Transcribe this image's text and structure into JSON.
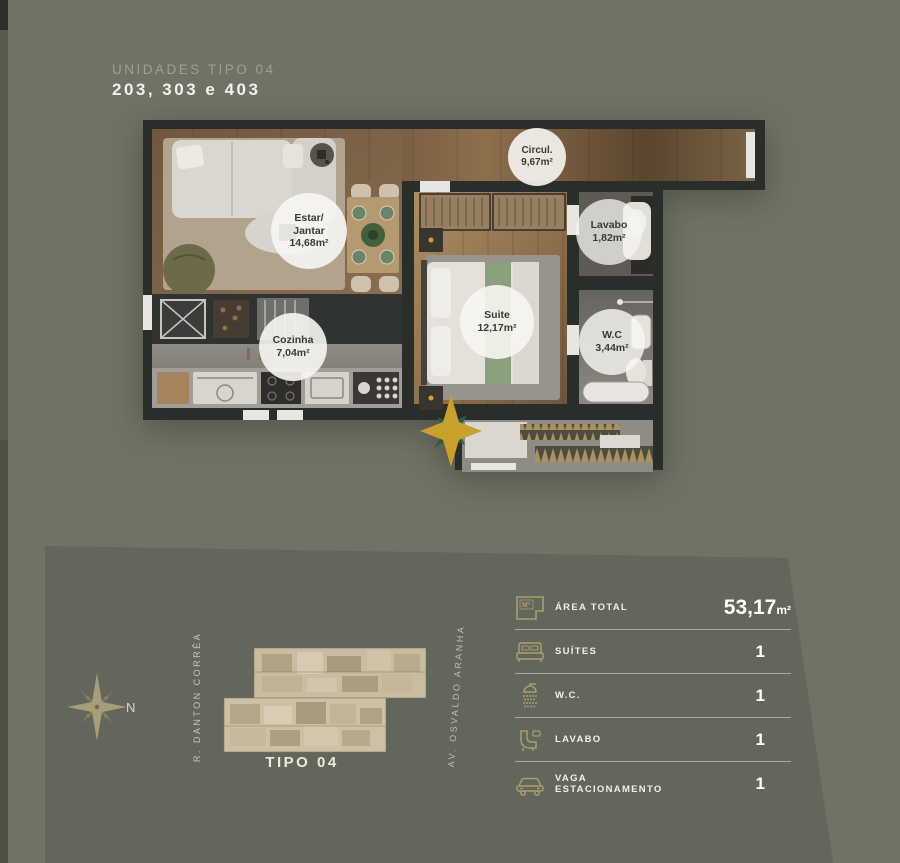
{
  "header": {
    "eyebrow": "UNIDADES TIPO 04",
    "title": "203, 303 e 403"
  },
  "floorplan": {
    "rooms": {
      "estar": {
        "l1": "Estar/",
        "l2": "Jantar",
        "l3": "14,68m²"
      },
      "circul": {
        "l1": "Circul.",
        "l2": "9,67m²"
      },
      "lavabo": {
        "l1": "Lavabo",
        "l2": "1,82m²"
      },
      "suite": {
        "l1": "Suite",
        "l2": "12,17m²"
      },
      "wc": {
        "l1": "W.C",
        "l2": "3,44m²"
      },
      "cozinha": {
        "l1": "Cozinha",
        "l2": "7,04m²"
      }
    }
  },
  "site": {
    "compass_label": "N",
    "street_left": "R. DANTON CORRÊA",
    "street_right": "AV. OSVALDO ARANHA",
    "miniplan_label": "TIPO 04"
  },
  "specs": {
    "area_icon_text": "M²",
    "rows": [
      {
        "label": "ÁREA TOTAL",
        "value": "53,17",
        "unit": "m²"
      },
      {
        "label": "SUÍTES",
        "value": "1"
      },
      {
        "label": "W.C.",
        "value": "1"
      },
      {
        "label": "LAVABO",
        "value": "1"
      },
      {
        "label": "VAGA ESTACIONAMENTO",
        "value": "1"
      }
    ]
  },
  "colors": {
    "background": "#6f7264",
    "platform": "#63665a",
    "accent_gold": "#a89f6e",
    "wall": "#2a2e2a",
    "badge_text": "#3a3a36"
  }
}
